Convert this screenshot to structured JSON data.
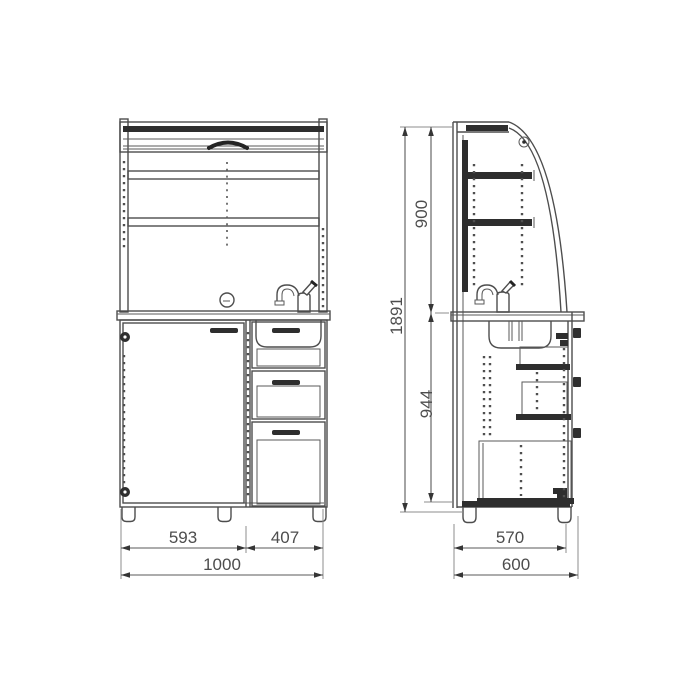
{
  "drawing": {
    "dimensions_mm": {
      "door_width": "593",
      "drawer_width": "407",
      "total_width": "1000",
      "body_depth": "570",
      "total_depth": "600",
      "total_height": "1891",
      "upper_height": "900",
      "base_height": "944"
    },
    "colors": {
      "line": "#4d4d4d",
      "dark_fill": "#2e2e2e",
      "dimension": "#5a5a5a",
      "background": "#ffffff"
    }
  }
}
